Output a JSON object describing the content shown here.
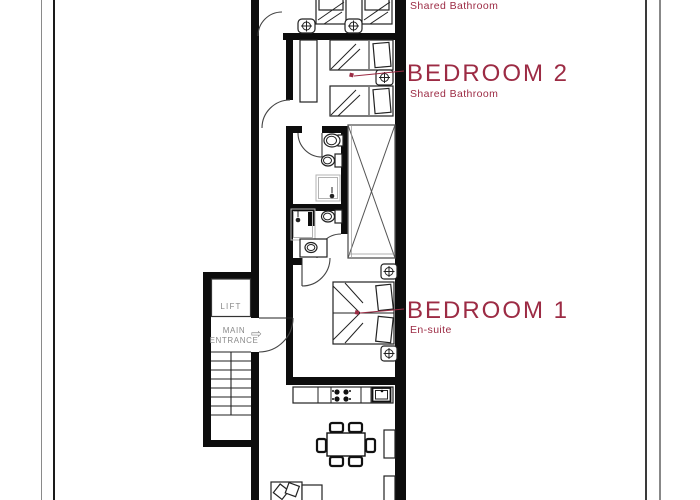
{
  "colors": {
    "label_red": "#9c2b44",
    "gray_label": "#8a8a8a",
    "wall_black": "#0d0d0d"
  },
  "labels": {
    "top_room_sub": "Shared Bathroom",
    "bedroom2_title": "BEDROOM 2",
    "bedroom2_sub": "Shared Bathroom",
    "bedroom1_title": "BEDROOM 1",
    "bedroom1_sub": "En-suite",
    "lift": "LIFT",
    "entrance_line1": "MAIN",
    "entrance_line2": "ENTRANCE",
    "entrance_arrow": "⇨"
  }
}
